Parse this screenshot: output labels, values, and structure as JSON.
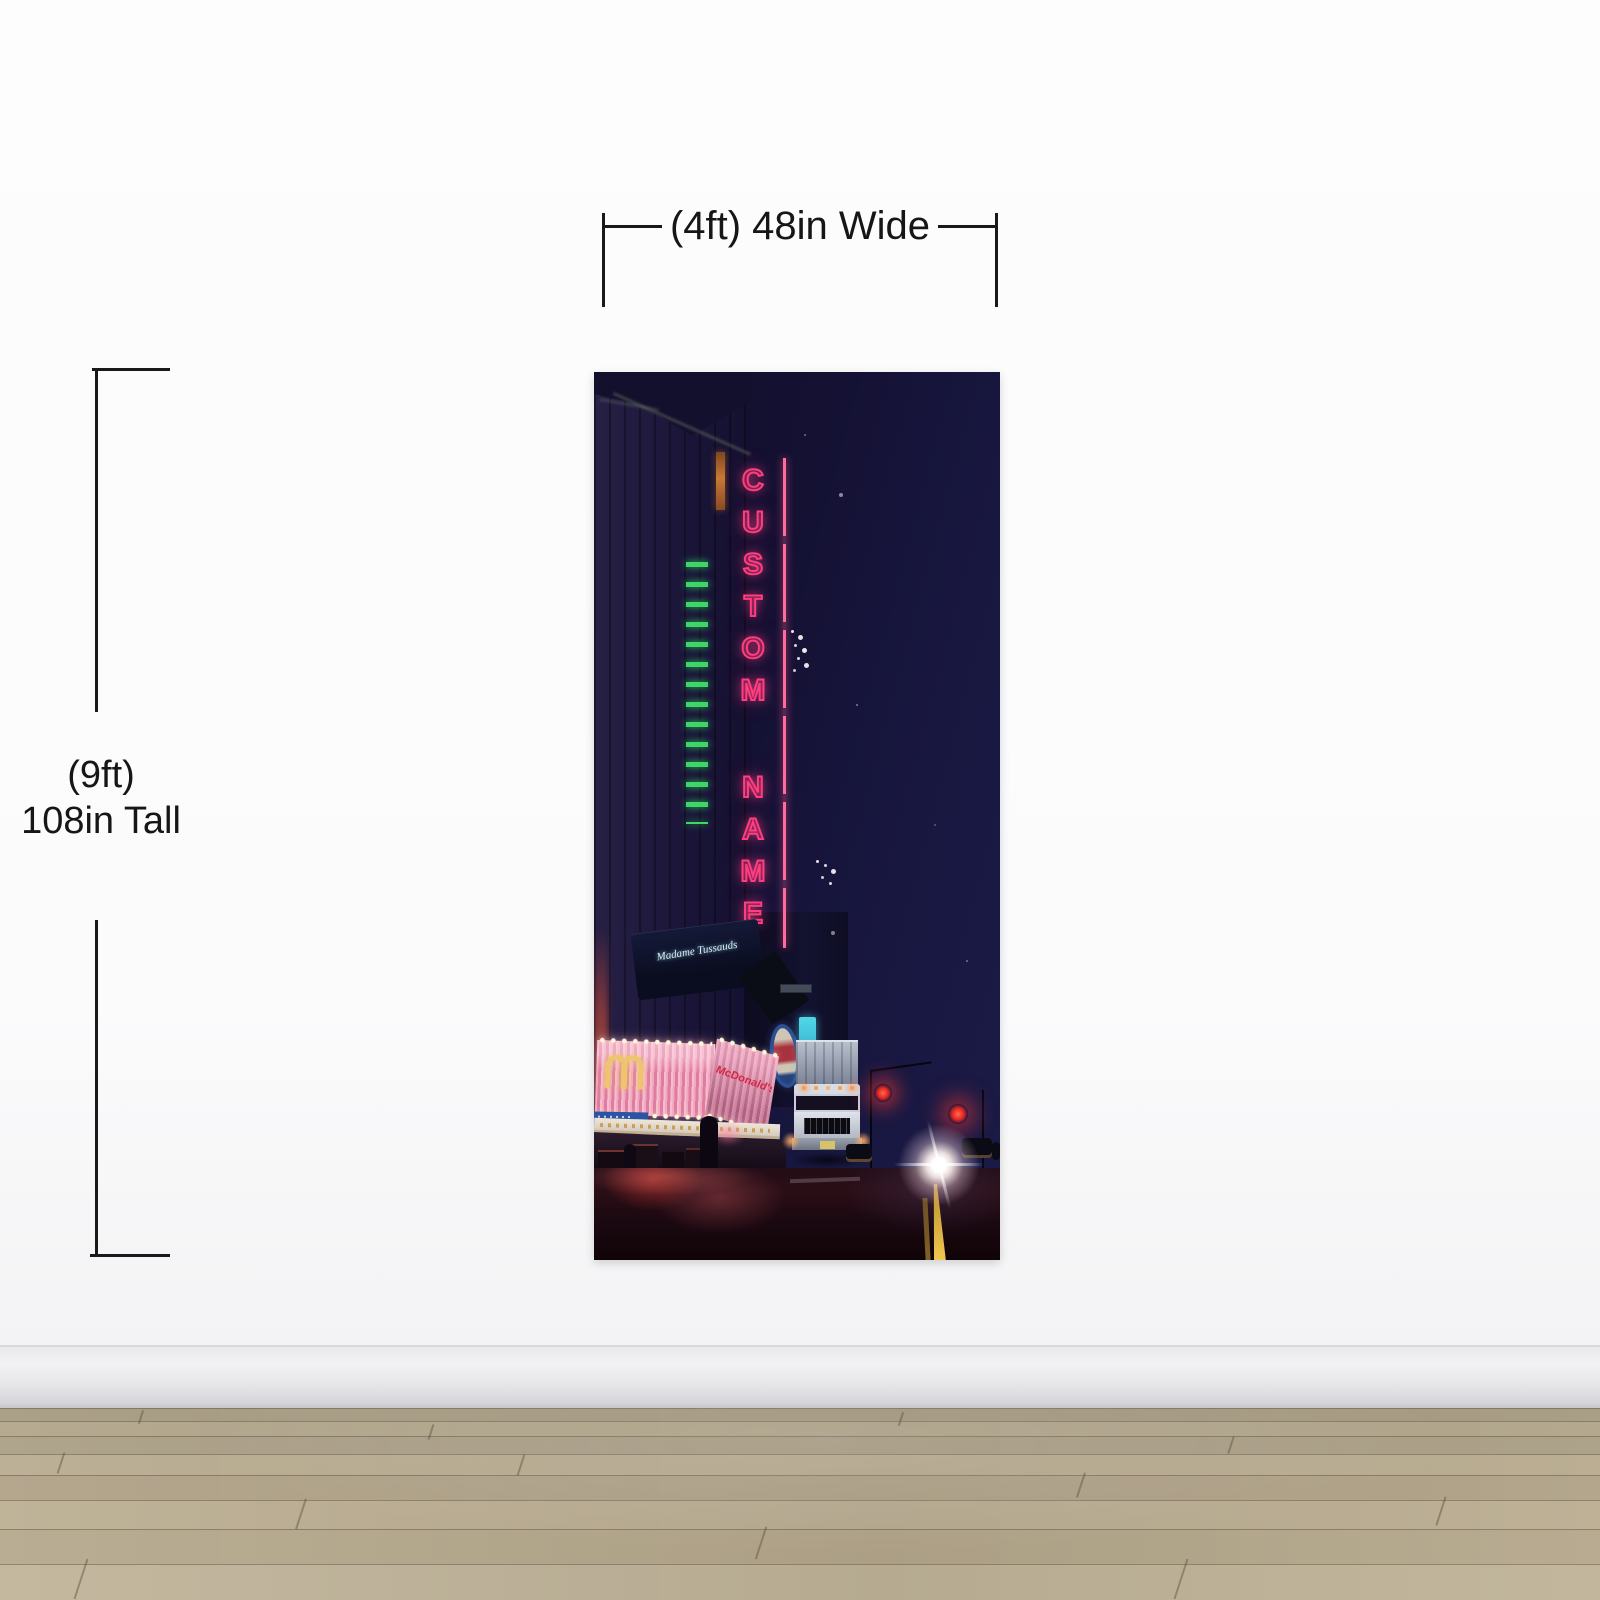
{
  "annotations": {
    "width_label": "(4ft) 48in Wide",
    "height_label_line1": "(9ft)",
    "height_label_line2": "108in Tall"
  },
  "mural": {
    "neon_sign": {
      "word1": [
        "C",
        "U",
        "S",
        "T",
        "O",
        "M"
      ],
      "word2": [
        "N",
        "A",
        "M",
        "E"
      ],
      "color": "#ff3d7f"
    },
    "awning_script": "Madame Tussauds",
    "marquee_script": "McDonald's",
    "em_sign_text": "EM",
    "colors": {
      "sky_navy": "#15123a",
      "neon_green": "#3fe26b",
      "marquee_pink": "#ef9db8",
      "road_red_glow": "#c43a33",
      "lane_line_yellow": "#f2c94e",
      "teal_sign": "#35bcd6"
    }
  },
  "room": {
    "wall_color": "#fbfbfc",
    "baseboard_color": "#e4e4e7",
    "floor_wood_color": "#b3a68a"
  }
}
